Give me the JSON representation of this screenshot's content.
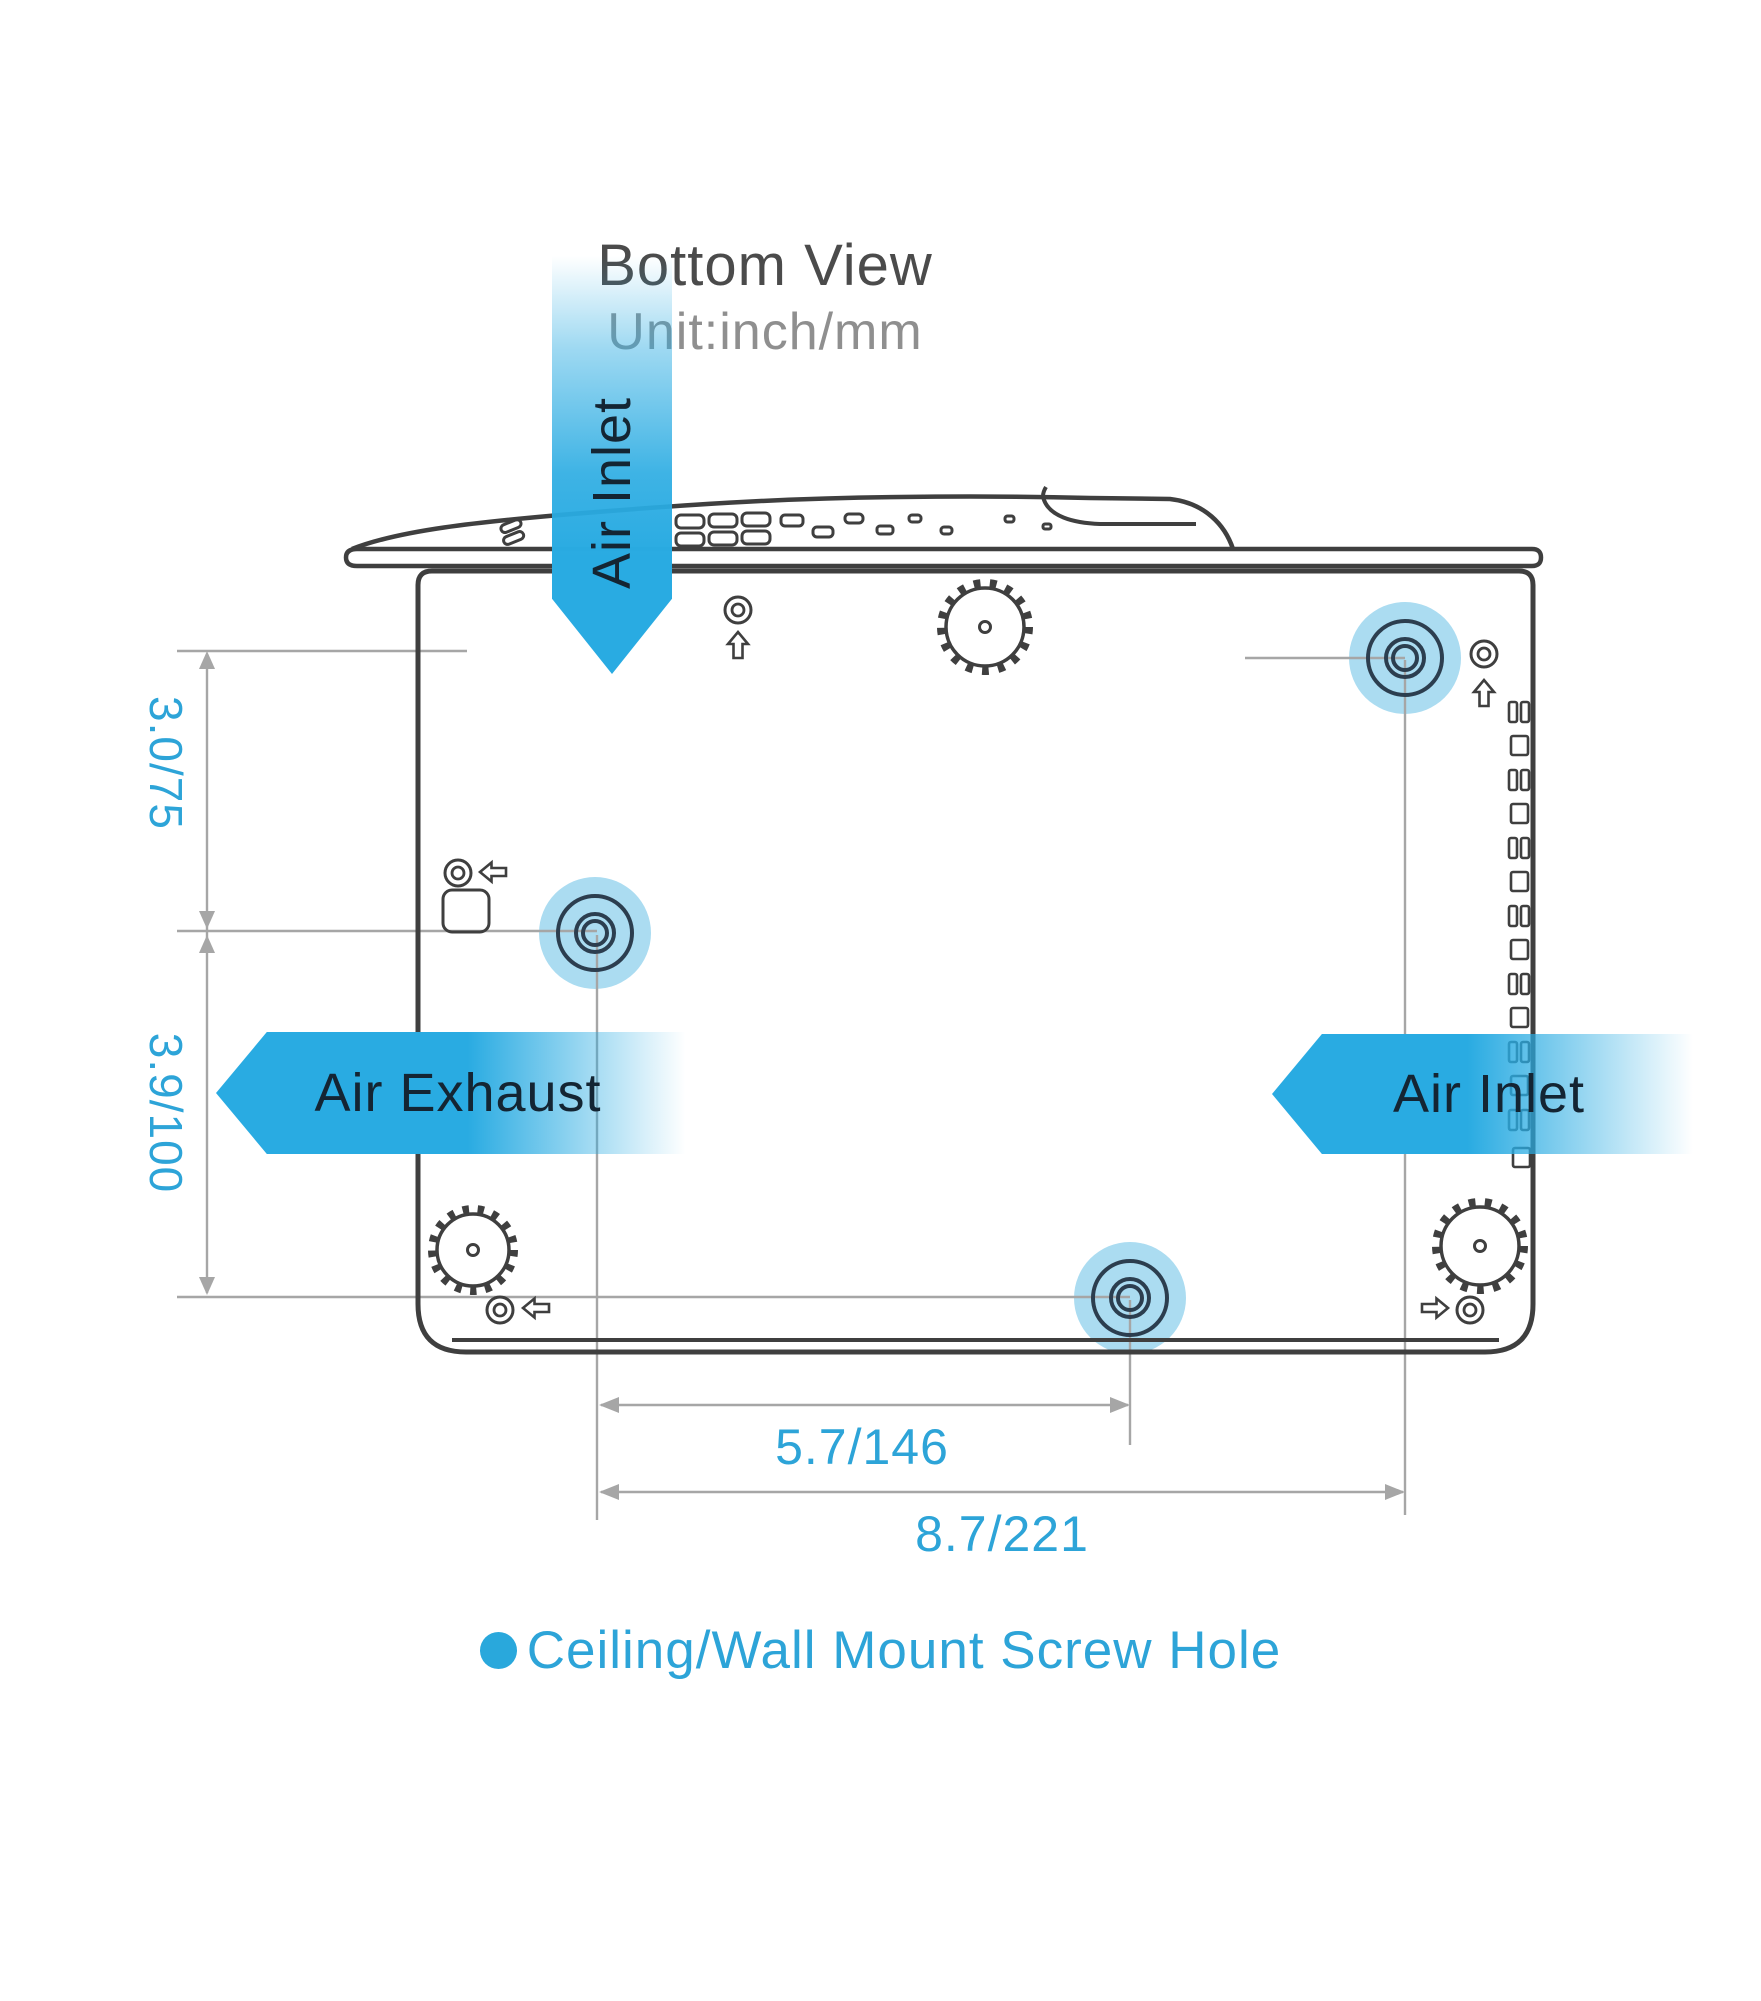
{
  "header": {
    "title": "Bottom View",
    "subtitle": "Unit:inch/mm"
  },
  "labels": {
    "air_inlet_top": "Air Inlet",
    "air_exhaust": "Air Exhaust",
    "air_inlet_right": "Air Inlet"
  },
  "dimensions": {
    "left_top": "3.0/75",
    "left_bottom": "3.9/100",
    "bottom_inner": "5.7/146",
    "bottom_outer": "8.7/221"
  },
  "legend": {
    "text": "Ceiling/Wall Mount Screw Hole"
  },
  "colors": {
    "accent_blue": "#29abe2",
    "screw_highlight_blue": "#abdcf1",
    "dimension_text_blue": "#2da4d8",
    "dimension_line_gray": "#a6a6a6",
    "outline_dark": "#3f3f3f",
    "ring_navy": "#2c3e4f",
    "label_navy": "#142533",
    "title_gray": "#4b4b4b",
    "subtitle_gray": "#8f8f8f"
  }
}
